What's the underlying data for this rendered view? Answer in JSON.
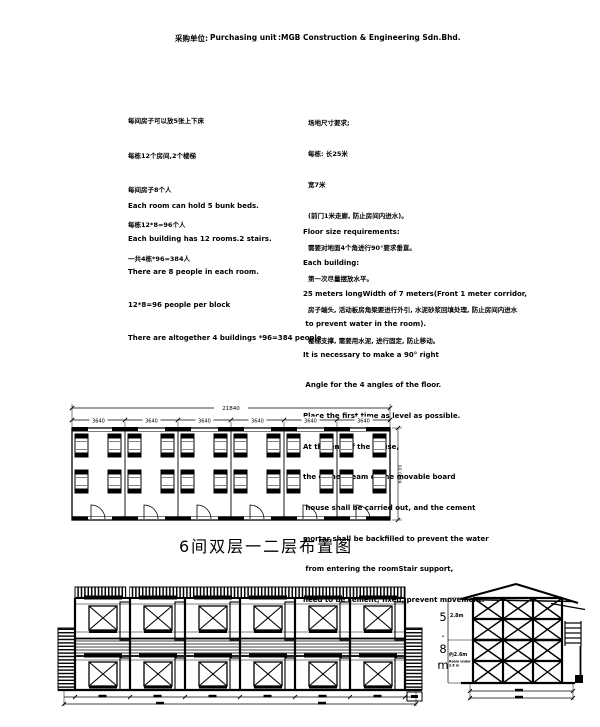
{
  "header": {
    "label_cn": "采购单位:",
    "label_en": "Purchasing unit",
    "value": ":MGB Construction & Engineering Sdn.Bhd."
  },
  "notes": {
    "cn_left": [
      "每间房子可以放5张上下床",
      "每栋12个房间,2个楼梯",
      "每间房子8个人",
      "每栋12*8=96个人",
      "一共4栋*96=384人"
    ],
    "cn_right": [
      "场地尺寸要求;",
      "每栋: 长25米",
      "宽7米",
      "(前门1米走廊, 防止房间内进水)。",
      "需要对地面4个角进行90°要求垂直。",
      "第一次尽量摆放水平。",
      "房子端头, 活动板房角梁要进行外引, 水泥砂浆回填处理, 防止房间内进水",
      "楼梯支撑, 需要用水泥, 进行固定, 防止移动。"
    ],
    "en_left": [
      "Each room can hold 5 bunk beds.",
      "Each building has 12 rooms.2 stairs.",
      "There are 8 people in each room.",
      "12*8=96 people per block",
      "There are altogether 4 buildings *96=384 people"
    ],
    "en_right": [
      "Floor size requirements:",
      "Each building:",
      "25 meters longWidth of 7 meters(Front 1 meter corridor,",
      " to prevent water in the room).",
      "It is necessary to make a 90° right",
      " Angle for the 4 angles of the floor.",
      "Place the first time as level as possible.",
      "At the end of the house,",
      "the corner beam of the movable board",
      " house shall be carried out, and the cement",
      "mortar shall be backfilled to prevent the water",
      " from entering the roomStair support,",
      "need to be cement, fixed, prevent movement."
    ]
  },
  "floor_plan": {
    "total_width": "21840",
    "bays": [
      "3640",
      "3640",
      "3640",
      "3640",
      "3640",
      "3640"
    ],
    "depth": "6980.00",
    "caption": "6间双层一二层布置图"
  },
  "side_elevation": {
    "overall_height": [
      "5",
      ".",
      "8",
      "m"
    ],
    "upper_height": "2.8m",
    "lower_height": "约2.6m",
    "lower_note1": "Room under",
    "lower_note2": "2.6 m"
  }
}
